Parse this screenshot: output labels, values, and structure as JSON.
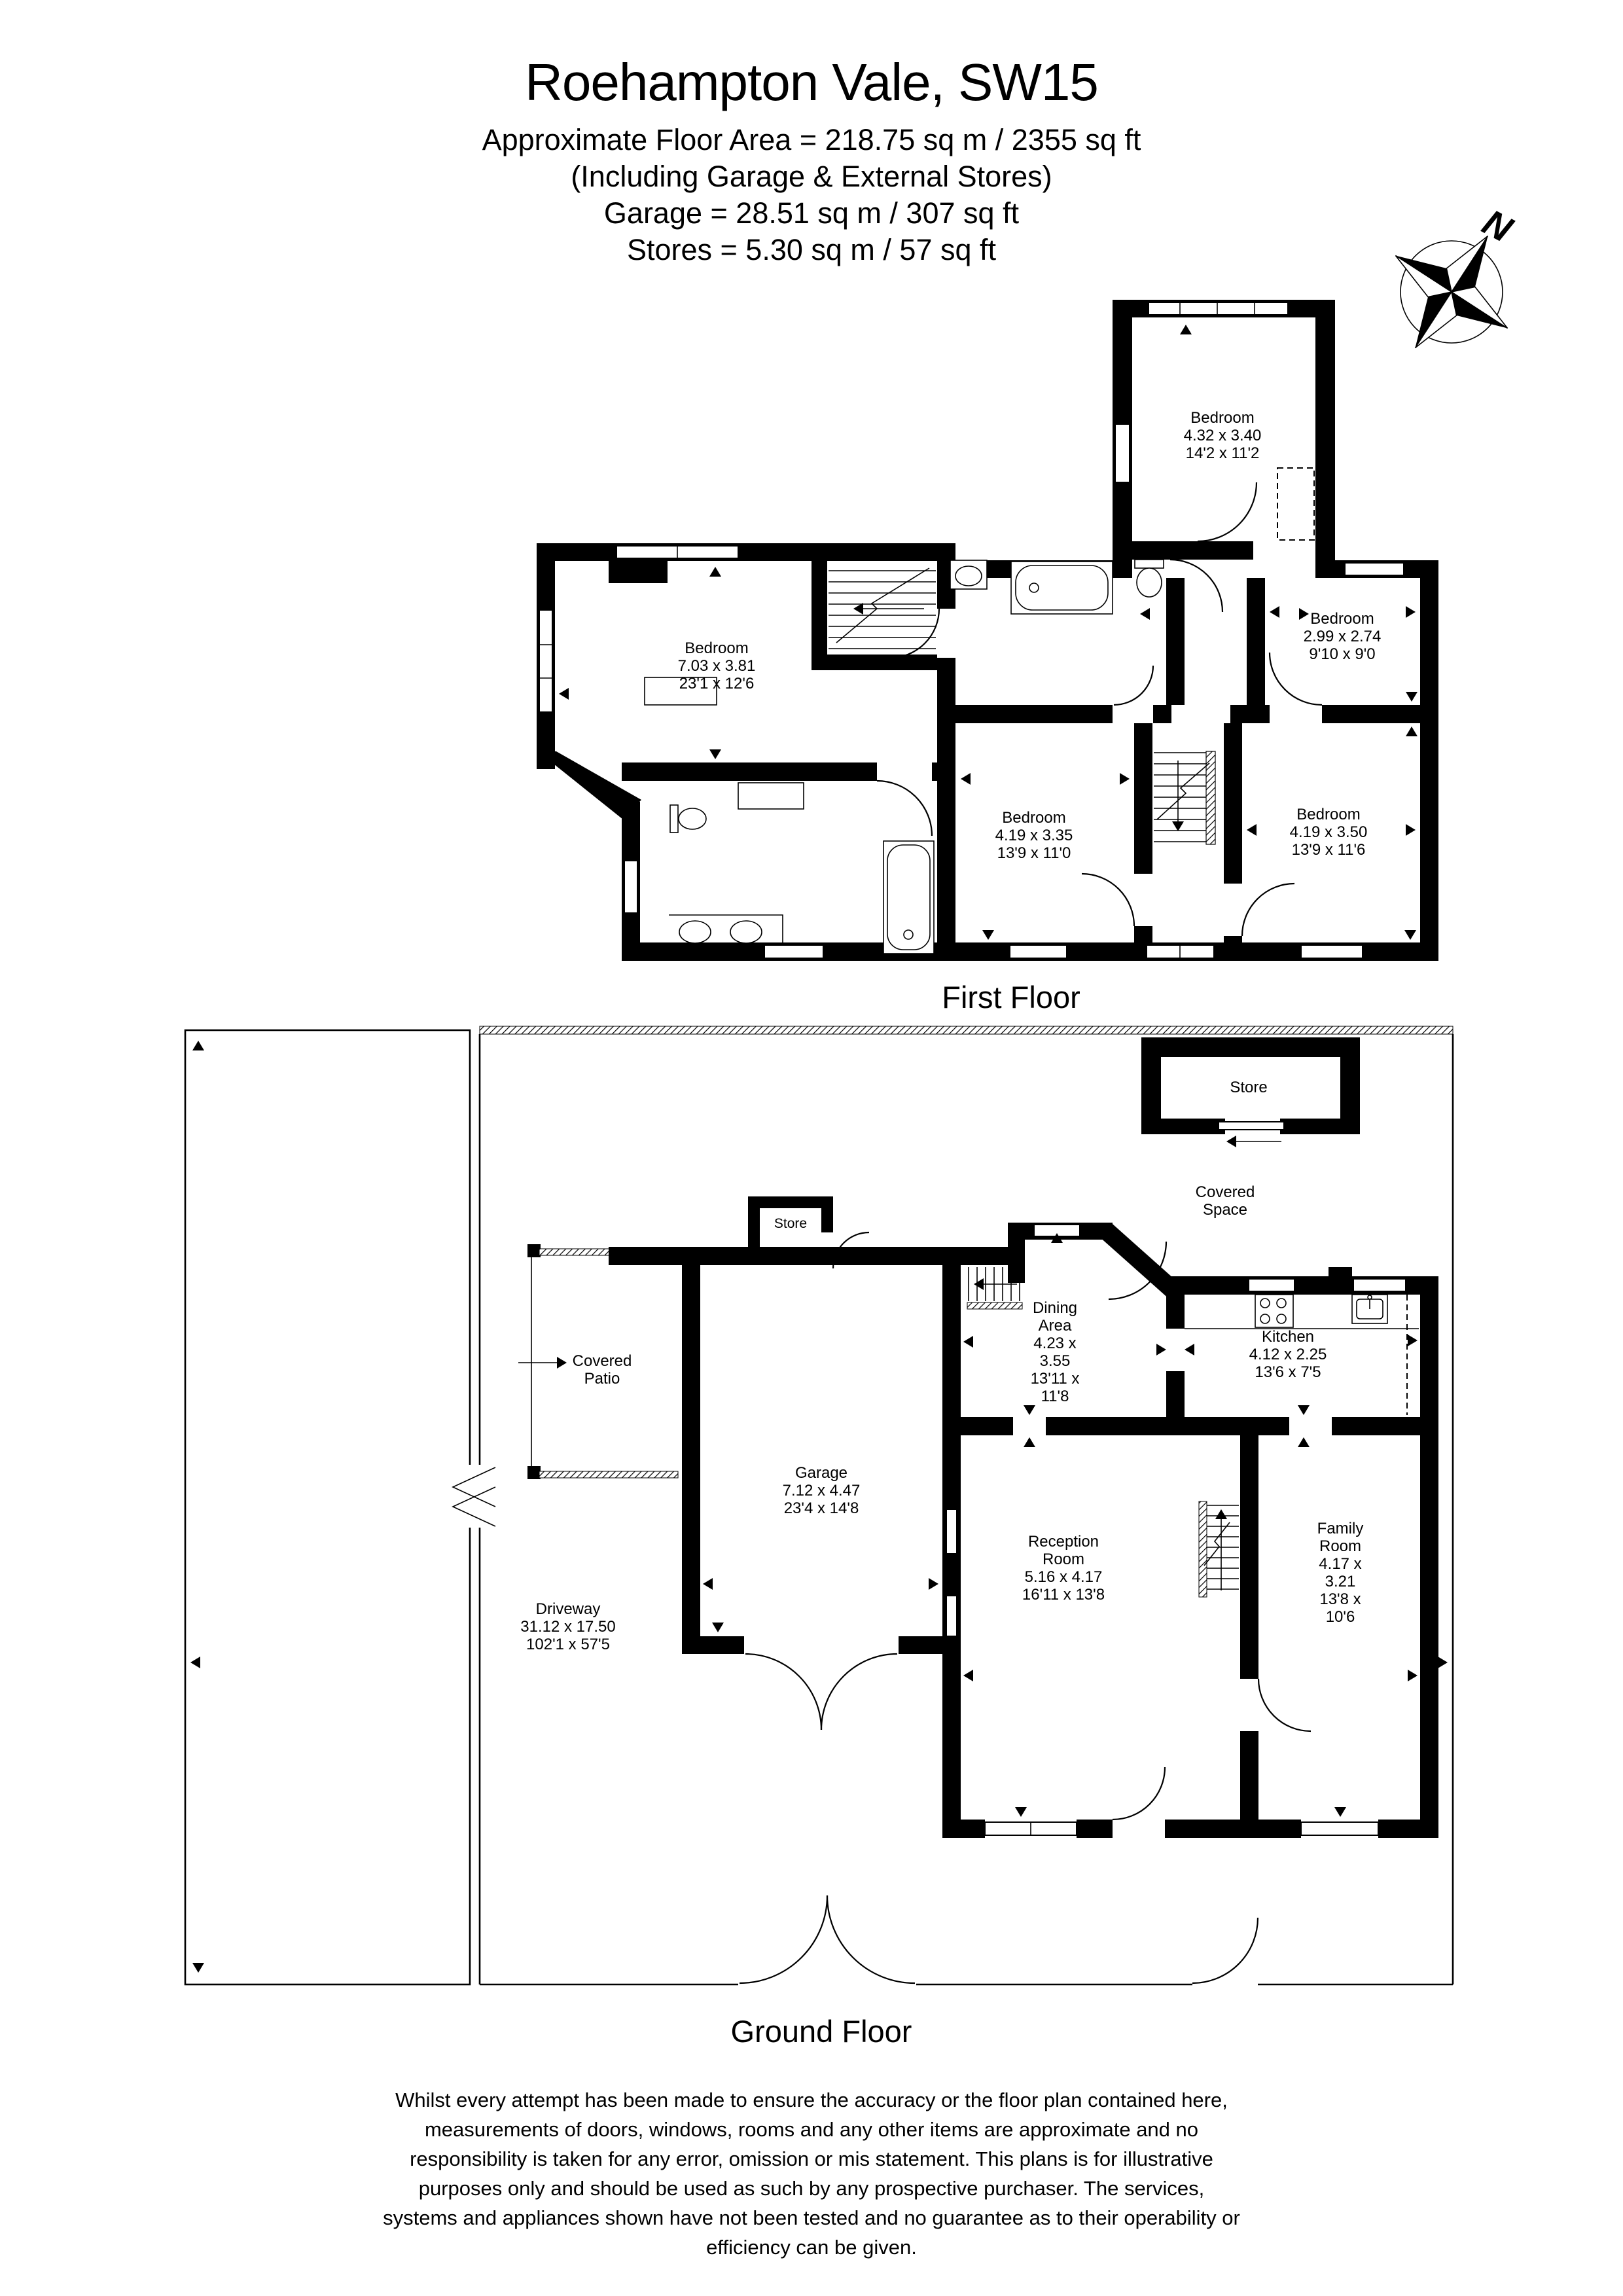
{
  "header": {
    "title": "Roehampton Vale, SW15",
    "subtitle_lines": [
      "Approximate Floor Area = 218.75 sq m / 2355 sq ft",
      "(Including Garage & External Stores)",
      "Garage = 28.51 sq m / 307 sq ft",
      "Stores = 5.30 sq m / 57 sq ft"
    ]
  },
  "compass": {
    "north_label": "N"
  },
  "first_floor": {
    "caption": "First Floor",
    "rooms": [
      {
        "name": "Bedroom",
        "metric": "4.32 x 3.40",
        "imperial": "14'2 x 11'2"
      },
      {
        "name": "Bedroom",
        "metric": "7.03 x 3.81",
        "imperial": "23'1 x 12'6"
      },
      {
        "name": "Bedroom",
        "metric": "2.99 x 2.74",
        "imperial": "9'10 x 9'0"
      },
      {
        "name": "Bedroom",
        "metric": "4.19 x 3.35",
        "imperial": "13'9 x 11'0"
      },
      {
        "name": "Bedroom",
        "metric": "4.19 x 3.50",
        "imperial": "13'9 x 11'6"
      }
    ]
  },
  "ground_floor": {
    "caption": "Ground Floor",
    "rooms": [
      {
        "name": "Store"
      },
      {
        "name": "Covered Space"
      },
      {
        "name": "Store"
      },
      {
        "name": "Covered Patio"
      },
      {
        "name": "Dining Area",
        "metric": "4.23 x 3.55",
        "imperial": "13'11 x 11'8"
      },
      {
        "name": "Kitchen",
        "metric": "4.12 x 2.25",
        "imperial": "13'6 x 7'5"
      },
      {
        "name": "Garage",
        "metric": "7.12 x 4.47",
        "imperial": "23'4 x 14'8"
      },
      {
        "name": "Reception Room",
        "metric": "5.16 x 4.17",
        "imperial": "16'11 x 13'8"
      },
      {
        "name": "Family Room",
        "metric": "4.17 x 3.21",
        "imperial": "13'8 x 10'6"
      },
      {
        "name": "Driveway",
        "metric": "31.12 x 17.50",
        "imperial": "102'1 x 57'5"
      }
    ]
  },
  "disclaimer": {
    "lines": [
      "Whilst every attempt has been made to ensure the accuracy or the floor plan contained here,",
      "measurements of doors, windows, rooms and any other items are approximate and no",
      "responsibility is taken for any error, omission or mis statement. This plans is for illustrative",
      "purposes only and should be used as such by any prospective purchaser. The services,",
      "systems and appliances shown have not been tested and no guarantee as to their operability or",
      "efficiency can be given."
    ]
  },
  "colors": {
    "ink": "#000000",
    "paper": "#ffffff"
  }
}
